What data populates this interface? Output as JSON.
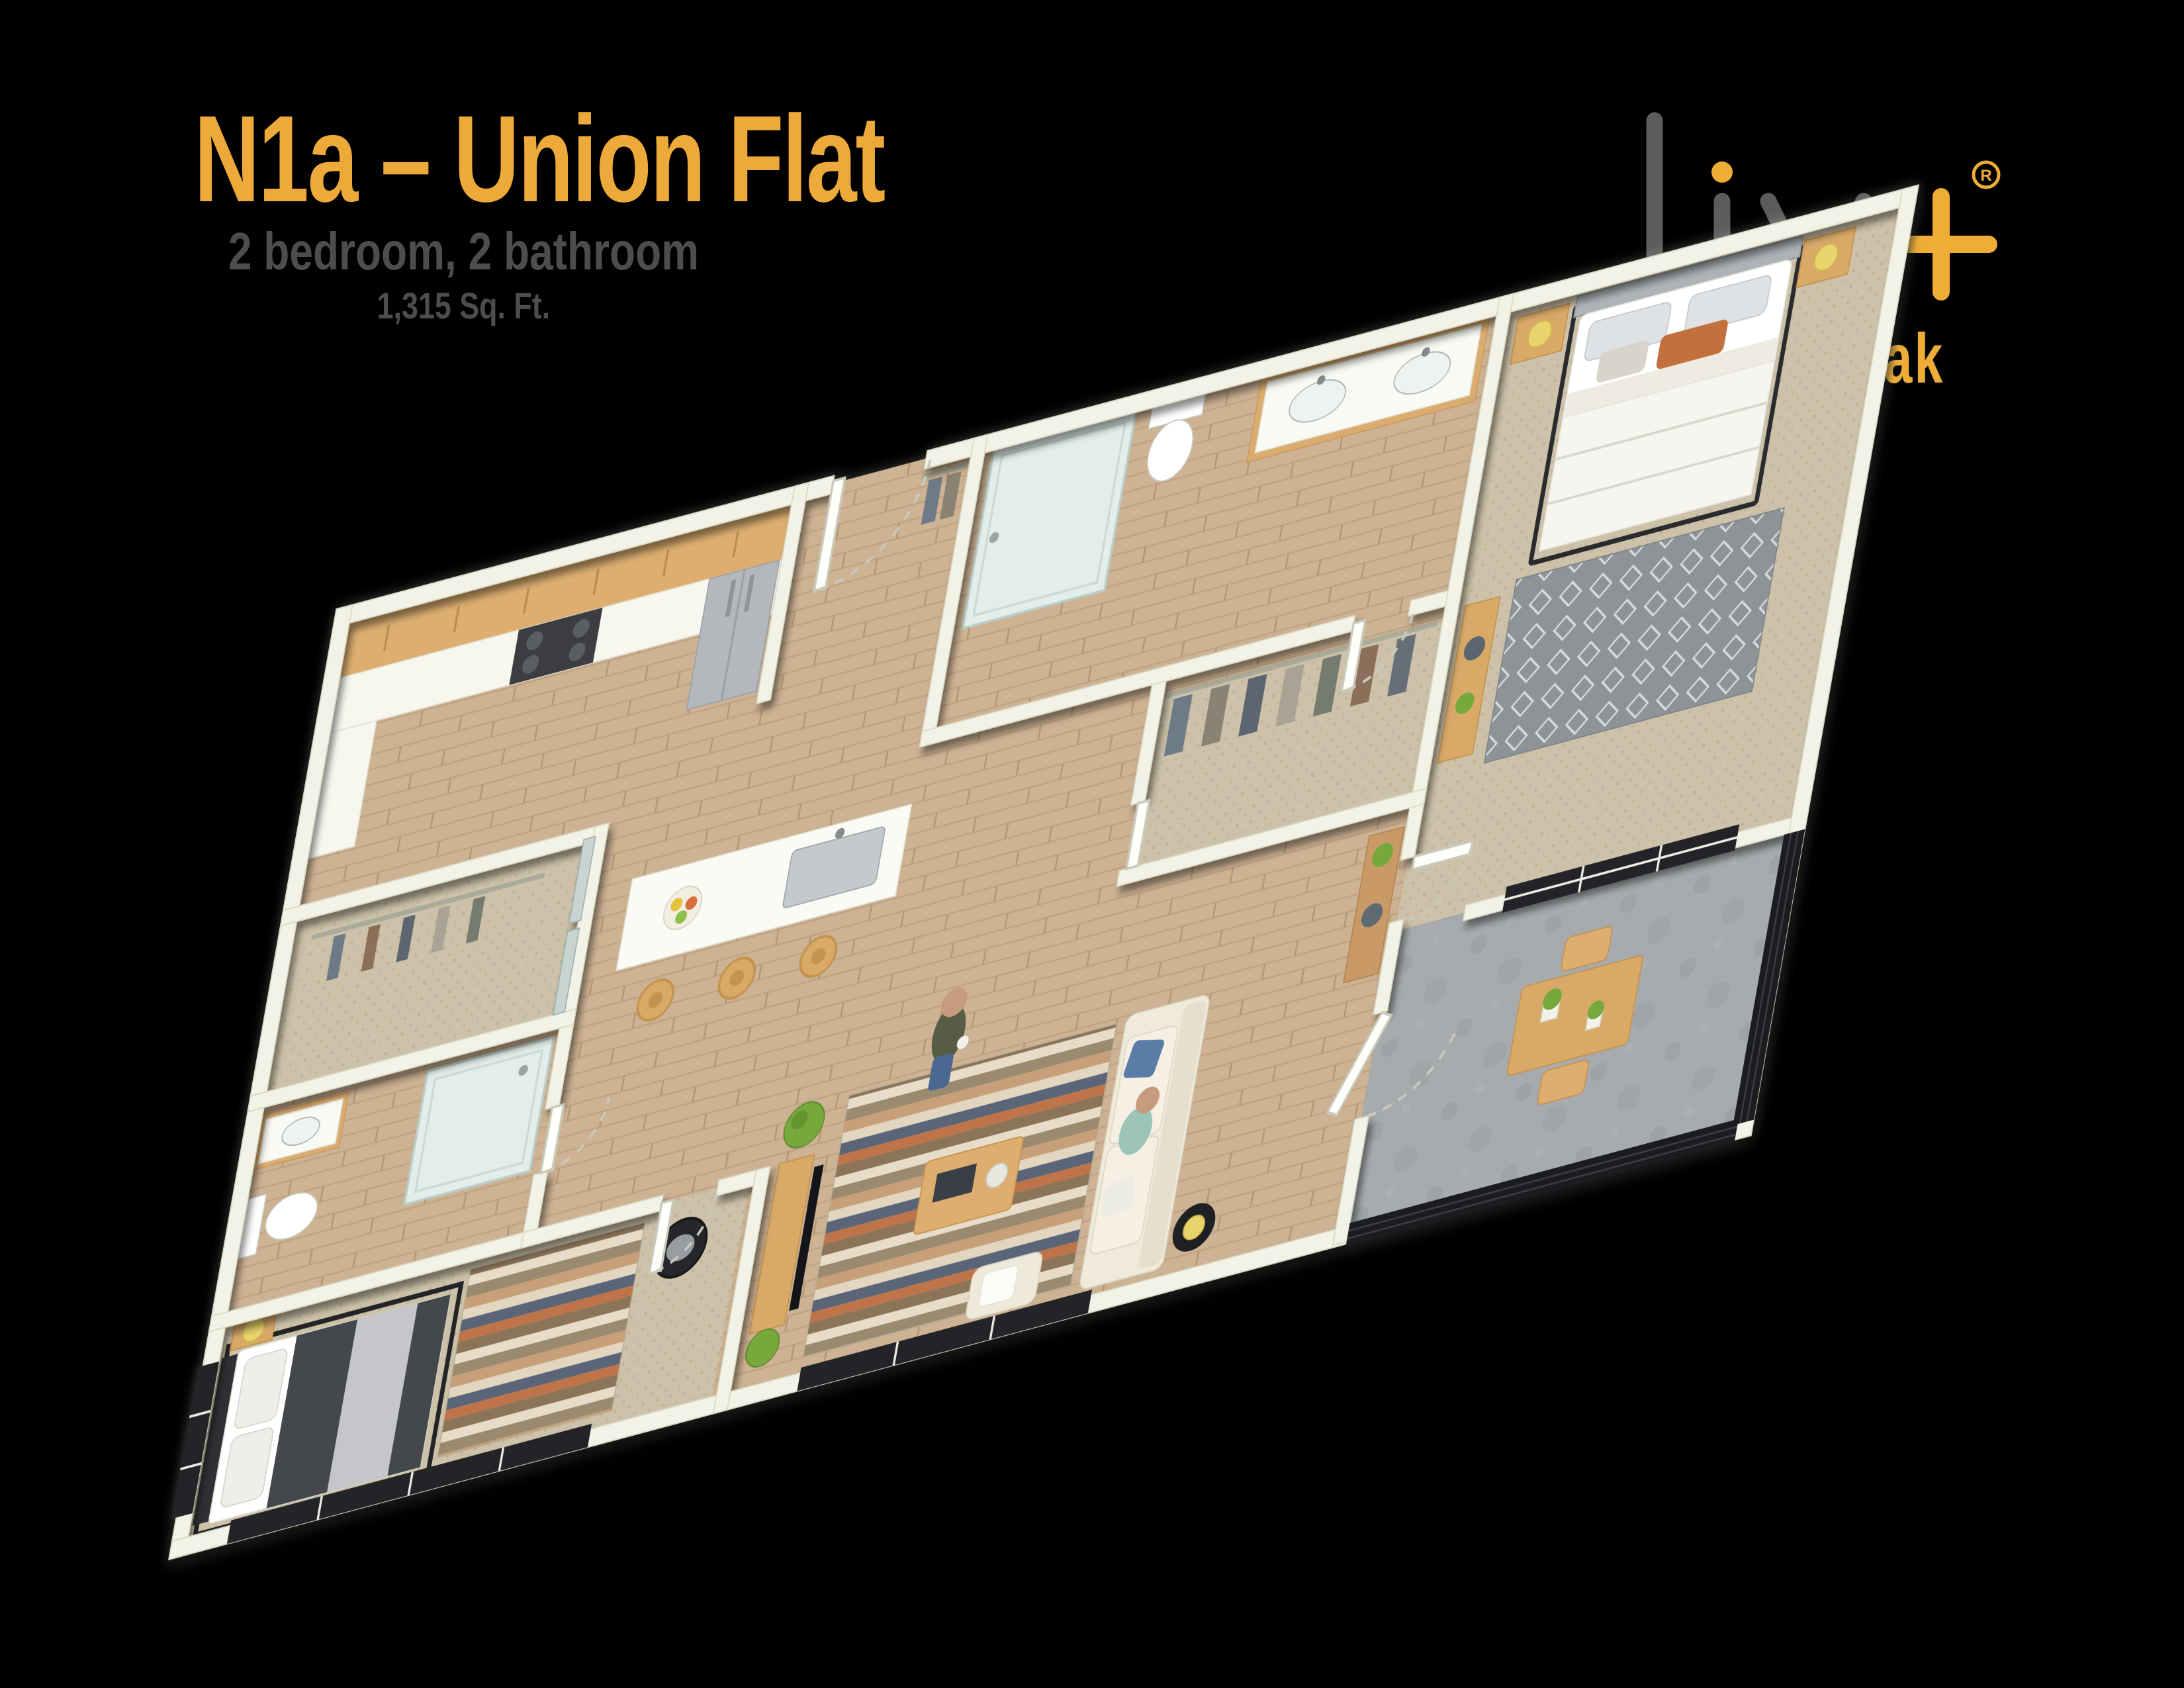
{
  "header": {
    "title": "N1a – Union Flat",
    "subtitle": "2 bedroom, 2 bathroom",
    "area": "1,315 Sq. Ft."
  },
  "logo": {
    "name": "liv",
    "plus": "+",
    "registered": "®",
    "tagline": "union peak"
  },
  "colors": {
    "background": "#000000",
    "accent_gold": "#EDAA3A",
    "subtitle_gray": "#4C4D4F",
    "logo_gray": "#5A5C5E",
    "wall_cream": "#F2F2E6",
    "wood_floor": "#CDB293",
    "carpet": "#CDC2A9",
    "balcony_concrete": "#A7ABAD",
    "cabinet_wood": "#DDAE70",
    "window_black": "#232427",
    "plant_green": "#76A83C"
  },
  "floorplan": {
    "style": "3d-isometric-render",
    "rooms": [
      {
        "name": "Kitchen",
        "features": [
          "upper-cabinets",
          "counter",
          "stove",
          "refrigerator",
          "island-with-sink",
          "bar-stools",
          "fruit-bowl"
        ]
      },
      {
        "name": "Entry",
        "features": [
          "front-door",
          "coat-closet"
        ]
      },
      {
        "name": "Bathroom 1",
        "features": [
          "walk-in-shower",
          "toilet",
          "double-sink-vanity"
        ]
      },
      {
        "name": "Walk-in Closet",
        "features": [
          "clothes-rod",
          "hanging-clothes"
        ]
      },
      {
        "name": "Closet",
        "features": [
          "mirrored-sliding-doors",
          "hanging-clothes"
        ]
      },
      {
        "name": "Bathroom 2",
        "features": [
          "vanity",
          "toilet",
          "glass-shower"
        ]
      },
      {
        "name": "Bedroom 2",
        "features": [
          "bed-dark-bedding",
          "black-bed-frame",
          "nightstand-with-lamp",
          "striped-rug",
          "round-wicker-chair",
          "black-frame-windows"
        ]
      },
      {
        "name": "Living Room",
        "features": [
          "sofa",
          "blue-pillow",
          "coffee-table",
          "striped-rug",
          "tv-console",
          "tv",
          "ottoman",
          "side-table-with-yellow-lamp",
          "potted-plants",
          "black-frame-window"
        ]
      },
      {
        "name": "Bedroom 1",
        "features": [
          "bed-white-bedding",
          "gray-headboard",
          "nightstands-with-yellow-lamps",
          "wall-art-frames",
          "patterned-gray-rug",
          "dresser-with-vase",
          "six-pane-window"
        ]
      },
      {
        "name": "Balcony",
        "features": [
          "concrete-floor",
          "wood-dining-table",
          "chairs",
          "planters",
          "black-metal-railing",
          "white-door"
        ]
      }
    ],
    "occupants": [
      "man-standing-with-mug",
      "person-seated-on-sofa"
    ]
  }
}
